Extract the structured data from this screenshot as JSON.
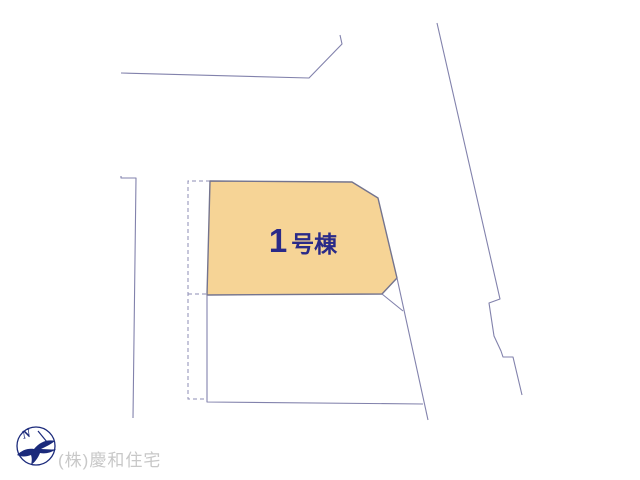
{
  "lot": {
    "number": "1",
    "suffix": "号棟"
  },
  "footer": {
    "company": "(株)慶和住宅"
  },
  "compass": {
    "north_label": "N"
  },
  "colors": {
    "background": "#ffffff",
    "boundary_line": "#8282ac",
    "dashed_line": "#8e8eb4",
    "lot_fill": "#f6d496",
    "lot_outline": "#74748e",
    "lot_label_text": "#2a2a88",
    "compass": "#1b2a7b",
    "company_text": "#c8c8c8"
  }
}
